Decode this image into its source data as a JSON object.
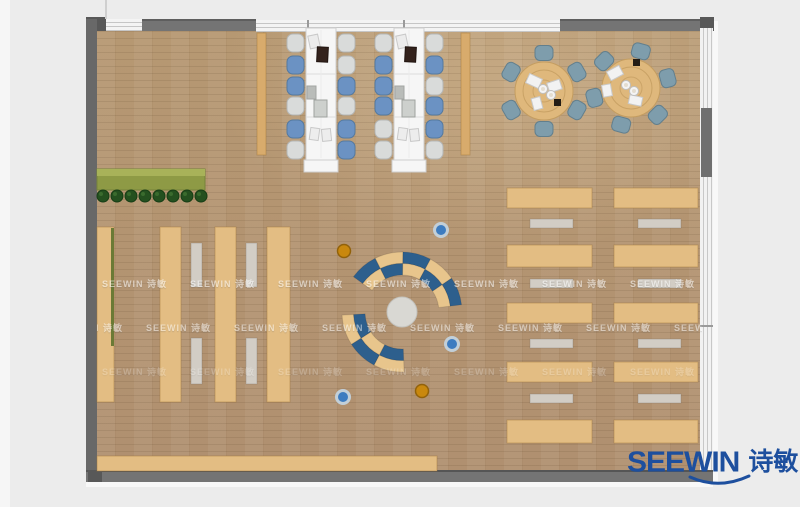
{
  "page": {
    "kind": "furniture floor plan rendering"
  },
  "logo": {
    "brand": "SEEWIN",
    "cn": "诗敏",
    "color": "#1d4f9e"
  },
  "watermark": {
    "text": "SEEWIN 诗敏",
    "rows": [
      {
        "y": 283,
        "opacity": 0.55
      },
      {
        "y": 327,
        "opacity": 0.5
      },
      {
        "y": 371,
        "opacity": 0.22
      }
    ],
    "x_start": 14,
    "x_step": 88,
    "row_x_offset": 44
  },
  "palette": {
    "wood_tan": "#e3bd83",
    "wood_tan_border": "rgba(160,118,58,0.45)",
    "side_strip": "#d8ab6c",
    "mat_gray": "#d2cdc5",
    "table_white": "#f6f6f6",
    "table_border": "#cfcfcf",
    "chair_blue": "#6b92c3",
    "chair_blue_border": "#54799f",
    "chair_gray": "#d9dbda",
    "chair_gray_border": "#b5b7b6",
    "round_table": "#dfb87c",
    "round_table_border": "#c49d60",
    "round_chair": "#7e9dac",
    "round_chair_border": "#627f8d",
    "ring_blue": "#2d5f8d",
    "ring_tan": "#e8c58c",
    "hub_gray": "#d9d8d3",
    "stool_blue": "#3d7cc0",
    "stool_blue_ring": "#c2cfd8",
    "stool_orange": "#c9880e",
    "stool_orange_ring": "#92620a",
    "planter_green": "#8e9a45",
    "planter_light": "#a8b259",
    "plant_dark": "#24501f",
    "hedge_green": "#6b7a35"
  },
  "furniture": {
    "shelf_strips": [
      {
        "x": 97,
        "y": 227,
        "w": 17,
        "h": 175
      },
      {
        "x": 160,
        "y": 227,
        "w": 21,
        "h": 175
      },
      {
        "x": 215,
        "y": 227,
        "w": 21,
        "h": 175
      },
      {
        "x": 267,
        "y": 227,
        "w": 23,
        "h": 175
      }
    ],
    "aisle_mats": [
      {
        "x": 191,
        "y": 243,
        "w": 11,
        "h": 44
      },
      {
        "x": 246,
        "y": 243,
        "w": 11,
        "h": 44
      },
      {
        "x": 191,
        "y": 338,
        "w": 11,
        "h": 46
      },
      {
        "x": 246,
        "y": 338,
        "w": 11,
        "h": 46
      }
    ],
    "side_strips": [
      {
        "x": 257,
        "y": 33,
        "w": 9,
        "h": 122
      },
      {
        "x": 461,
        "y": 33,
        "w": 9,
        "h": 122
      }
    ],
    "bottom_table": {
      "x": 97,
      "y": 456,
      "w": 340,
      "h": 15
    },
    "planter": {
      "x": 97,
      "y": 169,
      "w": 108,
      "h": 21,
      "plants": {
        "count": 8,
        "x0": 103,
        "step": 14,
        "y": 196,
        "r": 6
      }
    },
    "hedge": {
      "x": 111,
      "y": 228,
      "w": 3,
      "h": 118
    },
    "right_desks": {
      "columns": [
        {
          "x": 507,
          "w": 85,
          "mat_x": 530
        },
        {
          "x": 614,
          "w": 84,
          "mat_x": 638
        }
      ],
      "desk_rows": [
        188,
        245,
        303,
        362,
        420
      ],
      "desk_hs": [
        20,
        22,
        20,
        20,
        23
      ],
      "mat_rows": [
        219,
        279,
        339,
        394
      ],
      "mat_h": 9,
      "mat_w": 43
    },
    "long_tables": [
      {
        "x": 306,
        "y": 28,
        "w": 30,
        "h": 132,
        "ext": {
          "x": 304,
          "y": 160,
          "w": 34,
          "h": 12
        },
        "dividers": [
          74,
          117
        ],
        "chairs_left_x": 287,
        "chairs_right_x": 338,
        "chair_rows": [
          34,
          56,
          77,
          97,
          120,
          141
        ],
        "left_colors": [
          "gray",
          "blue",
          "blue",
          "gray",
          "blue",
          "gray"
        ],
        "right_colors": [
          "gray",
          "gray",
          "blue",
          "gray",
          "blue",
          "blue"
        ],
        "items": [
          {
            "x": 309,
            "y": 35,
            "w": 10,
            "h": 13,
            "rot": -12,
            "fill": "#ececec",
            "stroke": "#c9c9c9"
          },
          {
            "x": 317,
            "y": 47,
            "w": 11,
            "h": 15,
            "rot": 3,
            "fill": "#33221c",
            "stroke": "#1f130f"
          },
          {
            "x": 307,
            "y": 86,
            "w": 9,
            "h": 13,
            "rot": 0,
            "fill": "#b9bcb9",
            "stroke": "#a2a5a2"
          },
          {
            "x": 314,
            "y": 100,
            "w": 13,
            "h": 17,
            "rot": 0,
            "fill": "#cdd0cd",
            "stroke": "#9fa29f"
          },
          {
            "x": 310,
            "y": 128,
            "w": 9,
            "h": 12,
            "rot": 8,
            "fill": "#ededed",
            "stroke": "#c9c9c9"
          },
          {
            "x": 322,
            "y": 129,
            "w": 9,
            "h": 12,
            "rot": -6,
            "fill": "#ededed",
            "stroke": "#c9c9c9"
          }
        ]
      },
      {
        "x": 394,
        "y": 28,
        "w": 30,
        "h": 132,
        "ext": {
          "x": 392,
          "y": 160,
          "w": 34,
          "h": 12
        },
        "dividers": [
          74,
          117
        ],
        "chairs_left_x": 375,
        "chairs_right_x": 426,
        "chair_rows": [
          34,
          56,
          77,
          97,
          120,
          141
        ],
        "left_colors": [
          "gray",
          "blue",
          "blue",
          "blue",
          "gray",
          "gray"
        ],
        "right_colors": [
          "gray",
          "blue",
          "gray",
          "blue",
          "blue",
          "gray"
        ],
        "items": [
          {
            "x": 397,
            "y": 35,
            "w": 10,
            "h": 13,
            "rot": -12,
            "fill": "#ececec",
            "stroke": "#c9c9c9"
          },
          {
            "x": 405,
            "y": 47,
            "w": 11,
            "h": 15,
            "rot": 3,
            "fill": "#33221c",
            "stroke": "#1f130f"
          },
          {
            "x": 395,
            "y": 86,
            "w": 9,
            "h": 13,
            "rot": 0,
            "fill": "#b9bcb9",
            "stroke": "#a2a5a2"
          },
          {
            "x": 402,
            "y": 100,
            "w": 13,
            "h": 17,
            "rot": 0,
            "fill": "#cdd0cd",
            "stroke": "#9fa29f"
          },
          {
            "x": 398,
            "y": 128,
            "w": 9,
            "h": 12,
            "rot": 8,
            "fill": "#ededed",
            "stroke": "#c9c9c9"
          },
          {
            "x": 410,
            "y": 129,
            "w": 9,
            "h": 12,
            "rot": -6,
            "fill": "#ededed",
            "stroke": "#c9c9c9"
          }
        ]
      }
    ],
    "round_tables": [
      {
        "cx": 544,
        "cy": 91,
        "r": 29,
        "chair_angles": [
          90,
          150,
          210,
          270,
          330,
          30
        ],
        "papers": [
          {
            "x": 527,
            "y": 76,
            "w": 14,
            "h": 10,
            "rot": 25
          },
          {
            "x": 548,
            "y": 81,
            "w": 13,
            "h": 10,
            "rot": -18
          },
          {
            "x": 531,
            "y": 99,
            "w": 12,
            "h": 9,
            "rot": 75
          }
        ],
        "plates": [
          [
            543,
            89
          ],
          [
            551,
            95
          ]
        ],
        "dark_item": [
          554,
          99
        ]
      },
      {
        "cx": 631,
        "cy": 88,
        "r": 29,
        "chair_angles": [
          75,
          135,
          195,
          255,
          315,
          15
        ],
        "papers": [
          {
            "x": 608,
            "y": 68,
            "w": 14,
            "h": 10,
            "rot": -28
          },
          {
            "x": 601,
            "y": 86,
            "w": 12,
            "h": 9,
            "rot": 80
          },
          {
            "x": 629,
            "y": 96,
            "w": 13,
            "h": 9,
            "rot": 12
          }
        ],
        "plates": [
          [
            626,
            85
          ],
          [
            634,
            91
          ]
        ],
        "dark_item": [
          633,
          59
        ]
      }
    ],
    "ring": {
      "cx": 402,
      "cy": 312,
      "hub_r": 15,
      "bands": [
        {
          "r0": 48.5,
          "r1": 60,
          "arcs": [
            {
              "a": [
                7,
                34.4
              ],
              "c": "blue"
            },
            {
              "a": [
                34.4,
                61.8
              ],
              "c": "tan"
            },
            {
              "a": [
                61.8,
                89.2
              ],
              "c": "blue"
            },
            {
              "a": [
                89.2,
                116.6
              ],
              "c": "tan"
            },
            {
              "a": [
                116.6,
                144
              ],
              "c": "blue"
            },
            {
              "a": [
                183,
                212.7
              ],
              "c": "tan"
            },
            {
              "a": [
                212.7,
                242.3
              ],
              "c": "blue"
            },
            {
              "a": [
                242.3,
                272
              ],
              "c": "tan"
            }
          ]
        },
        {
          "r0": 37,
          "r1": 48.5,
          "arcs": [
            {
              "a": [
                7,
                34.4
              ],
              "c": "tan"
            },
            {
              "a": [
                34.4,
                61.8
              ],
              "c": "blue"
            },
            {
              "a": [
                61.8,
                89.2
              ],
              "c": "tan"
            },
            {
              "a": [
                89.2,
                116.6
              ],
              "c": "blue"
            },
            {
              "a": [
                116.6,
                144
              ],
              "c": "tan"
            },
            {
              "a": [
                183,
                212.7
              ],
              "c": "blue"
            },
            {
              "a": [
                212.7,
                242.3
              ],
              "c": "tan"
            },
            {
              "a": [
                242.3,
                272
              ],
              "c": "blue"
            }
          ]
        }
      ]
    },
    "stools": [
      {
        "x": 441,
        "y": 230,
        "kind": "blue"
      },
      {
        "x": 452,
        "y": 344,
        "kind": "blue"
      },
      {
        "x": 343,
        "y": 397,
        "kind": "blue"
      },
      {
        "x": 344,
        "y": 251,
        "kind": "orange"
      },
      {
        "x": 422,
        "y": 391,
        "kind": "orange"
      }
    ]
  }
}
